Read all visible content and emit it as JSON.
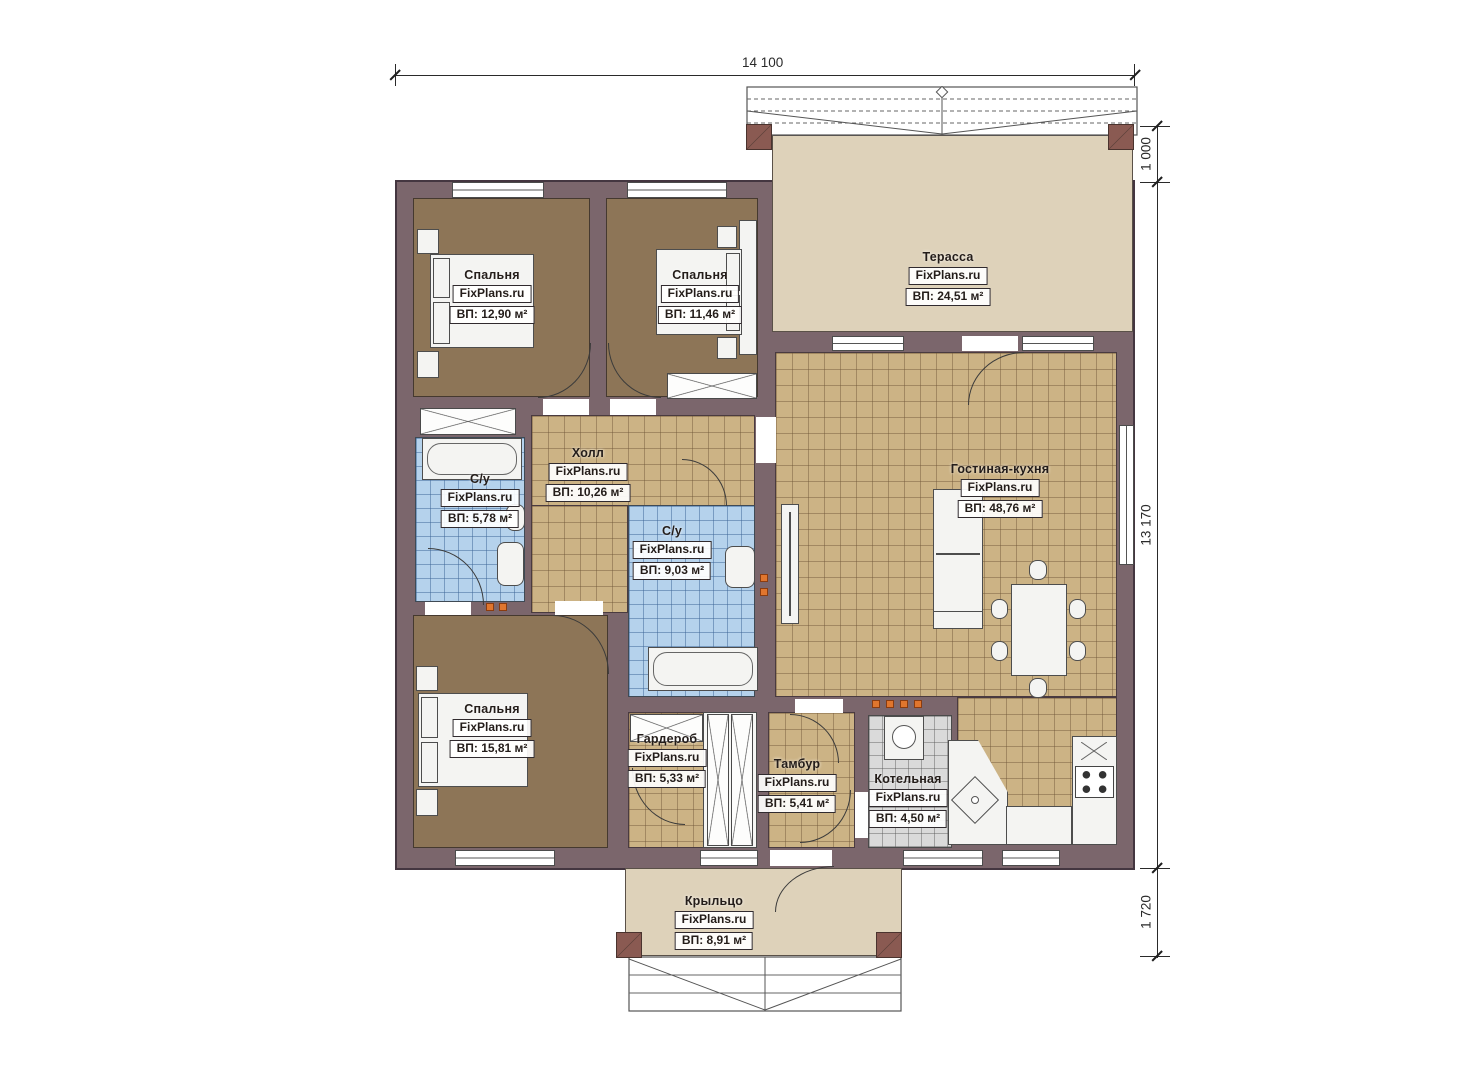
{
  "brand": "FixPlans.ru",
  "dimensions": {
    "top": "14 100",
    "right_top": "1 000",
    "right_mid": "13 170",
    "right_bottom": "1 720"
  },
  "rooms": [
    {
      "key": "bedroom-top-left",
      "name": "Спальня",
      "brand": "FixPlans.ru",
      "area": "ВП: 12,90 м²"
    },
    {
      "key": "bedroom-top-middle",
      "name": "Спальня",
      "brand": "FixPlans.ru",
      "area": "ВП: 11,46 м²"
    },
    {
      "key": "terrace",
      "name": "Терасса",
      "brand": "FixPlans.ru",
      "area": "ВП: 24,51 м²"
    },
    {
      "key": "hall",
      "name": "Холл",
      "brand": "FixPlans.ru",
      "area": "ВП: 10,26 м²"
    },
    {
      "key": "bathroom-left",
      "name": "С/у",
      "brand": "FixPlans.ru",
      "area": "ВП: 5,78 м²"
    },
    {
      "key": "bathroom-center",
      "name": "С/у",
      "brand": "FixPlans.ru",
      "area": "ВП: 9,03 м²"
    },
    {
      "key": "living-kitchen",
      "name": "Гостиная-кухня",
      "brand": "FixPlans.ru",
      "area": "ВП: 48,76 м²"
    },
    {
      "key": "bedroom-bottom",
      "name": "Спальня",
      "brand": "FixPlans.ru",
      "area": "ВП: 15,81 м²"
    },
    {
      "key": "wardrobe",
      "name": "Гардероб",
      "brand": "FixPlans.ru",
      "area": "ВП: 5,33 м²"
    },
    {
      "key": "vestibule",
      "name": "Тамбур",
      "brand": "FixPlans.ru",
      "area": "ВП: 5,41 м²"
    },
    {
      "key": "boiler-room",
      "name": "Котельная",
      "brand": "FixPlans.ru",
      "area": "ВП: 4,50 м²"
    },
    {
      "key": "porch",
      "name": "Крыльцо",
      "brand": "FixPlans.ru",
      "area": "ВП: 8,91 м²"
    }
  ],
  "colors": {
    "wall": "#7b666c",
    "bedroom_floor": "#8d7557",
    "tile_floor": "#ccb385",
    "bath_tile": "#b5d2ec",
    "terrace_floor": "#ded2ba",
    "vent_marker": "#e0762e"
  }
}
